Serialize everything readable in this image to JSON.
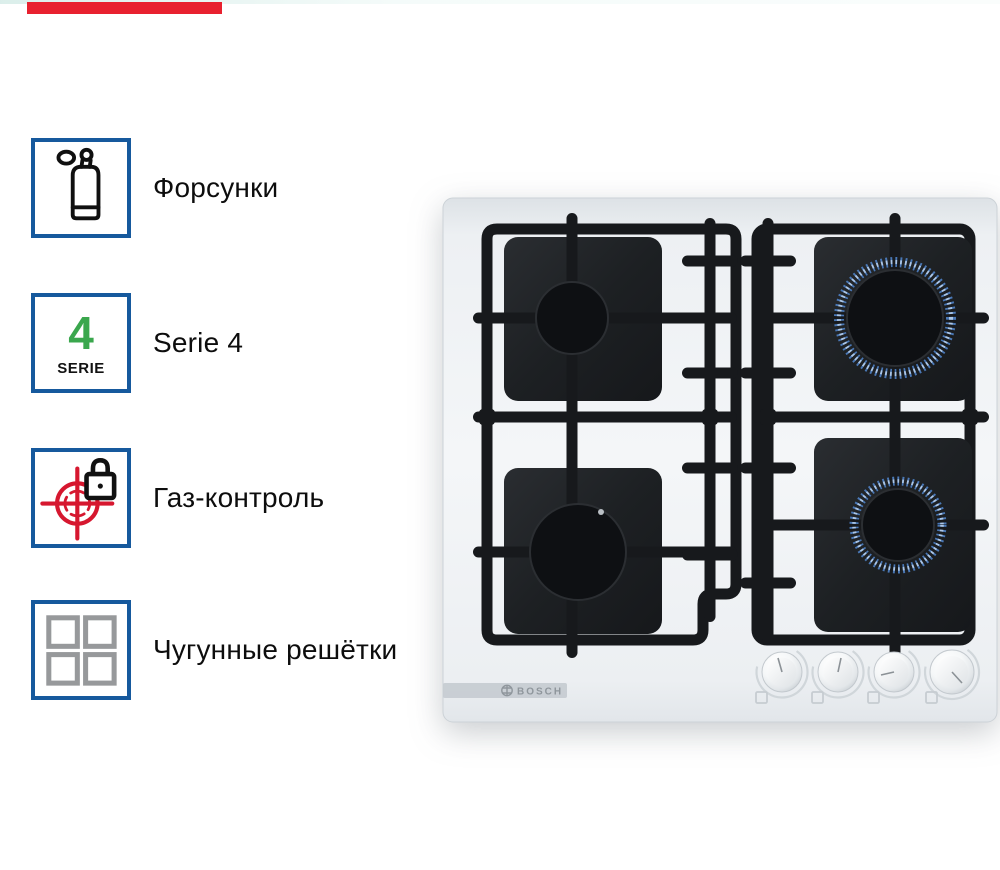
{
  "page": {
    "background_color": "#ffffff",
    "top_tint_color": "#cfe9e3",
    "red_fragment_color": "#e8212f"
  },
  "features": [
    {
      "icon": "gas-cylinder-icon",
      "label": "Форсунки"
    },
    {
      "icon": "serie-badge-icon",
      "label": "Serie 4",
      "badge_number": "4",
      "badge_caption": "SERIE"
    },
    {
      "icon": "gas-control-lock-icon",
      "label": "Газ-контроль"
    },
    {
      "icon": "cast-iron-grid-icon",
      "label": "Чугунные решётки"
    }
  ],
  "badge_style": {
    "border_color": "#16599d",
    "number_green": "#3aa74d",
    "icon_black": "#101010",
    "icon_red": "#d6172f",
    "icon_gray": "#97999b"
  },
  "hob": {
    "brand": "BOSCH",
    "surface": "white glass",
    "knob_count": 4,
    "burners": [
      {
        "position": "top-left",
        "lit": false
      },
      {
        "position": "bottom-left",
        "lit": false
      },
      {
        "position": "top-right",
        "lit": true
      },
      {
        "position": "bottom-right",
        "lit": true
      }
    ],
    "flame_ring_color": "#7fa6d9",
    "grate_color": "#17191c"
  }
}
